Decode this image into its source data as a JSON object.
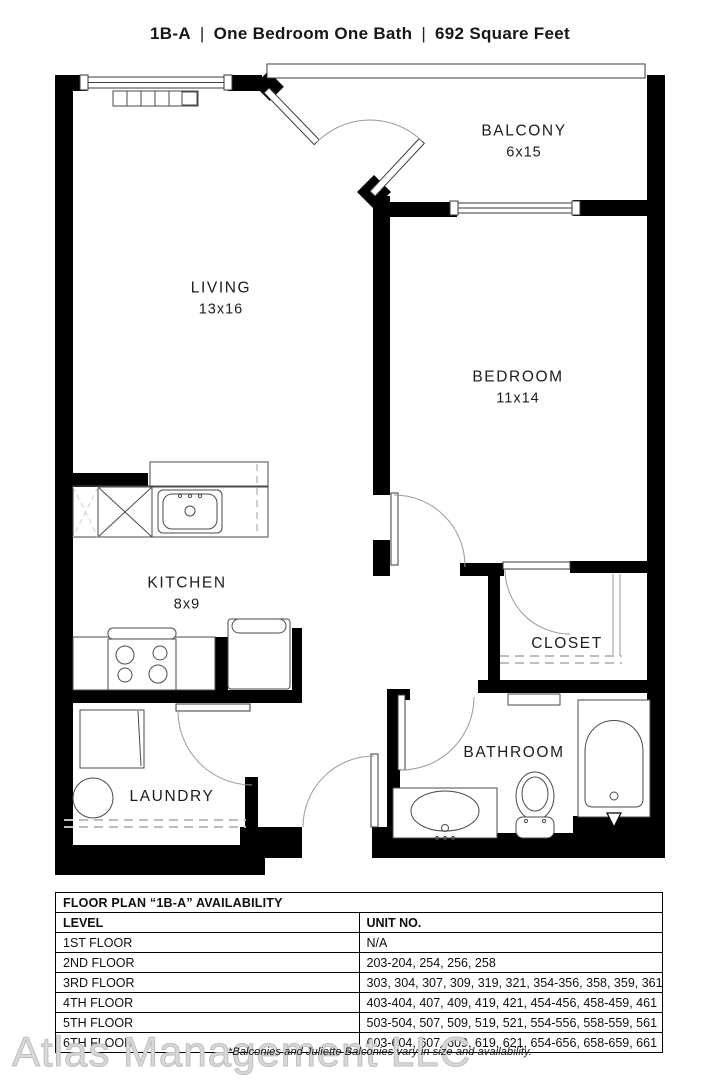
{
  "title": {
    "plan_code": "1B-A",
    "separator": "|",
    "description": "One Bedroom One Bath",
    "size": "692 Square Feet"
  },
  "rooms": {
    "living": {
      "name": "LIVING",
      "dims": "13x16"
    },
    "balcony": {
      "name": "BALCONY",
      "dims": "6x15"
    },
    "bedroom": {
      "name": "BEDROOM",
      "dims": "11x14"
    },
    "kitchen": {
      "name": "KITCHEN",
      "dims": "8x9"
    },
    "closet": {
      "name": "CLOSET"
    },
    "laundry": {
      "name": "LAUNDRY"
    },
    "bathroom": {
      "name": "BATHROOM"
    }
  },
  "availability": {
    "title": "FLOOR PLAN “1B-A” AVAILABILITY",
    "columns": [
      "LEVEL",
      "UNIT NO."
    ],
    "rows": [
      [
        "1ST FLOOR",
        "N/A"
      ],
      [
        "2ND FLOOR",
        "203-204, 254, 256, 258"
      ],
      [
        "3RD FLOOR",
        "303, 304, 307, 309, 319, 321, 354-356, 358, 359, 361"
      ],
      [
        "4TH FLOOR",
        "403-404, 407, 409, 419, 421, 454-456, 458-459, 461"
      ],
      [
        "5TH FLOOR",
        "503-504, 507, 509, 519, 521, 554-556, 558-559, 561"
      ],
      [
        "6TH FLOOR",
        "603-604, 607, 609, 619, 621, 654-656, 658-659, 661"
      ]
    ]
  },
  "footer": {
    "watermark": "Atlas Management LLC",
    "note": "*Balconies and Juliette Balconies vary in size and availability."
  },
  "colors": {
    "wall": "#000000",
    "background": "#ffffff",
    "watermark": "#d9d9d9"
  }
}
